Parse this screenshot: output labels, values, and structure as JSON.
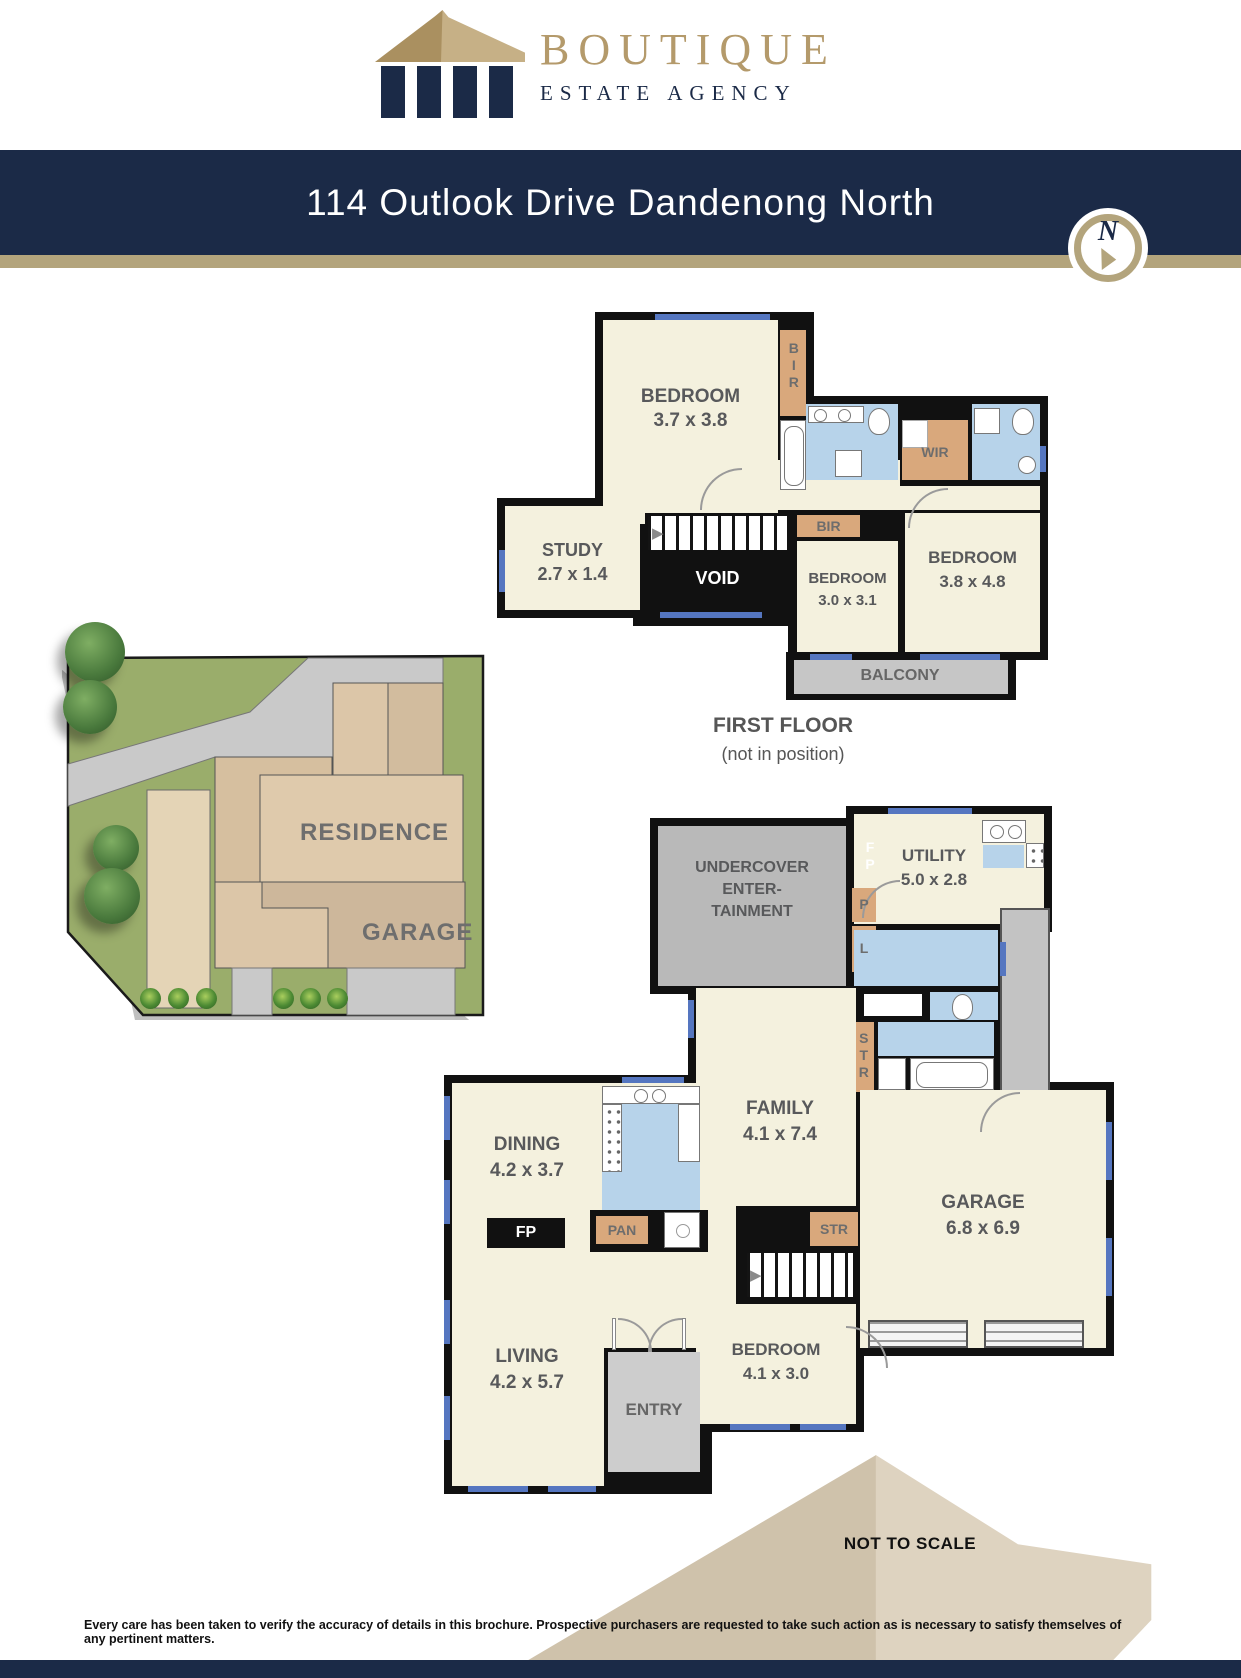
{
  "brand": {
    "primary": "BOUTIQUE",
    "secondary": "ESTATE AGENCY",
    "gold": "#b49a6b",
    "navy": "#1b2a47"
  },
  "header": {
    "address": "114 Outlook Drive Dandenong North",
    "compass_letter": "N"
  },
  "icons": {
    "stairs_arrow_right": "▶"
  },
  "first_floor": {
    "title": "FIRST FLOOR",
    "subtitle": "(not in position)",
    "bedroom1": {
      "name": "BEDROOM",
      "dims": "3.7 x 3.8"
    },
    "bir1": "BIR",
    "wir": "WIR",
    "study": {
      "name": "STUDY",
      "dims": "2.7 x 1.4"
    },
    "void": "VOID",
    "bir2": "BIR",
    "bedroom2": {
      "name": "BEDROOM",
      "dims": "3.0 x 3.1"
    },
    "bedroom3": {
      "name": "BEDROOM",
      "dims": "3.8 x 4.8"
    },
    "balcony": "BALCONY"
  },
  "site": {
    "residence": "RESIDENCE",
    "garage": "GARAGE"
  },
  "ground_floor": {
    "undercover_l1": "UNDERCOVER",
    "undercover_l2": "ENTER-",
    "undercover_l3": "TAINMENT",
    "fp_flue": "FP",
    "pantry_small": "P",
    "linen": "L",
    "utility": {
      "name": "UTILITY",
      "dims": "5.0 x 2.8"
    },
    "family": {
      "name": "FAMILY",
      "dims": "4.1 x 7.4"
    },
    "dining": {
      "name": "DINING",
      "dims": "4.2 x 3.7"
    },
    "fireplace": "FP",
    "pantry": "PAN",
    "str1": "STR",
    "str2": "STR",
    "living": {
      "name": "LIVING",
      "dims": "4.2 x 5.7"
    },
    "entry": "ENTRY",
    "bedroom4": {
      "name": "BEDROOM",
      "dims": "4.1 x 3.0"
    },
    "garage": {
      "name": "GARAGE",
      "dims": "6.8 x 6.9"
    }
  },
  "footer": {
    "scale_note": "NOT TO SCALE",
    "disclaimer": "Every care has been taken to verify the accuracy of details in this brochure. Prospective purchasers are requested to take such action as is necessary to satisfy themselves of any pertinent matters."
  },
  "colors": {
    "navy": "#1b2a47",
    "gold_stripe": "#b3a47c",
    "room_cream": "#f4f1de",
    "wet_blue": "#b7d3ea",
    "closet_tan": "#d9a87c",
    "lawn_green": "#9aad6b",
    "driveway_gray": "#c9c9c9",
    "residence_tan": "#dfcaac",
    "wall_black": "#111111",
    "window_blue": "#5576c0"
  }
}
